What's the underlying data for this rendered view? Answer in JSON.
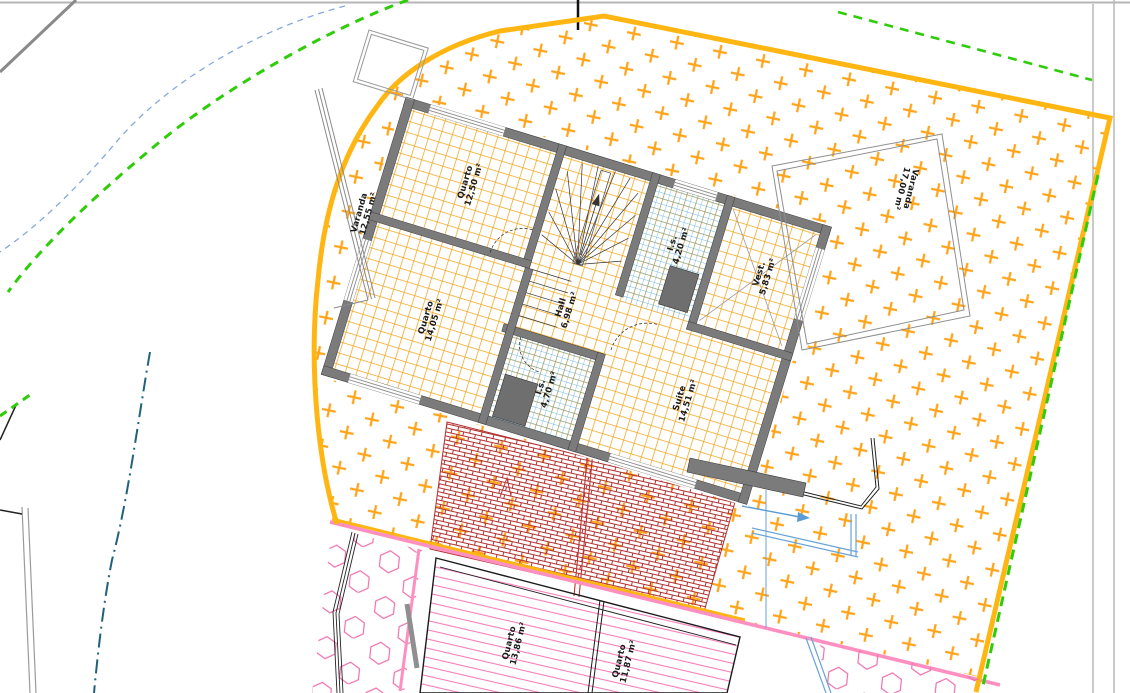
{
  "drawing": {
    "type": "architectural-floor-plan",
    "labels": {
      "varanda_left": {
        "name": "Varanda",
        "area": "12,55 m²"
      },
      "quarto_top": {
        "name": "Quarto",
        "area": "12,50 m²"
      },
      "is_top": {
        "name": "I.s.",
        "area": "4,20 m²"
      },
      "vest": {
        "name": "Vest.",
        "area": "5,83 m²"
      },
      "hall": {
        "name": "Hall",
        "area": "6,98 m²"
      },
      "quarto_mid": {
        "name": "Quarto",
        "area": "14,05 m²"
      },
      "is_bottom": {
        "name": "I.s.",
        "area": "4,70 m²"
      },
      "suite": {
        "name": "Suite",
        "area": "14,51 m²"
      },
      "varanda_right": {
        "name": "Varanda",
        "area": "17,00 m²"
      },
      "quarto_lower_left": {
        "name": "Quarto",
        "area": "13,86 m²"
      },
      "quarto_lower_right": {
        "name": "Quarto",
        "area": "11,87 m²"
      }
    },
    "colors": {
      "boundary_orange": "#FFB612",
      "hatch_plus_orange": "#FFA41B",
      "floor_grid_orange": "#F2A51E",
      "wall_gray": "#7B7B7B",
      "tile_blue": "#49A8D8",
      "brick_red": "#B23030",
      "pink_hatch": "#F47EB8",
      "pink_boundary": "#FF8FC0",
      "green_dashed": "#2FCC0A",
      "blue_dashed": "#85A9DE",
      "teal_dashdot": "#20627A"
    }
  }
}
